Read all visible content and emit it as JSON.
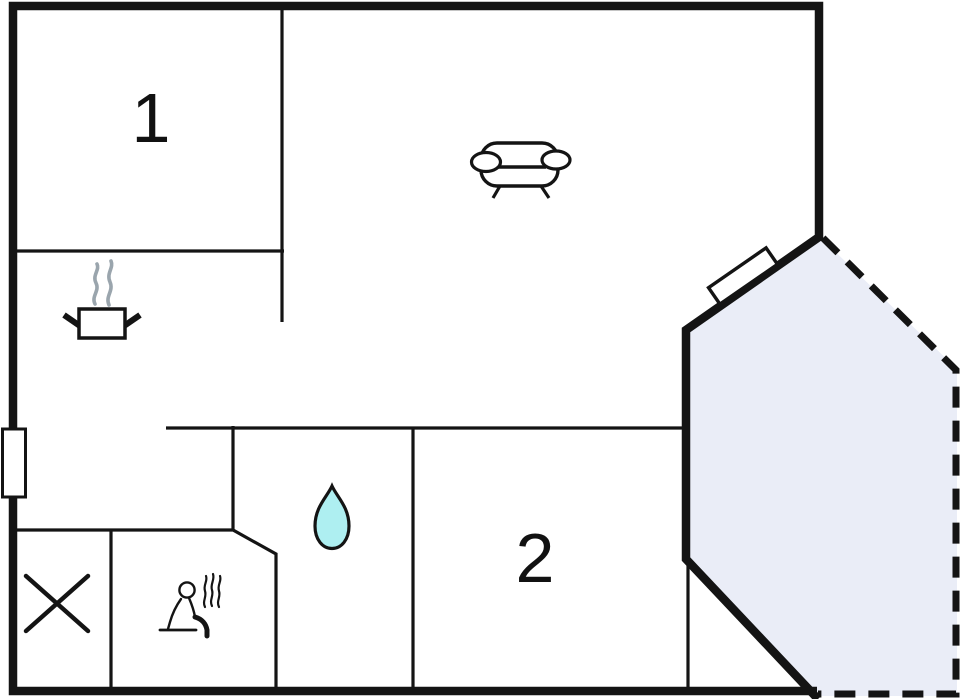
{
  "plan": {
    "rooms": [
      {
        "id": "room-1",
        "label": "1"
      },
      {
        "id": "room-2",
        "label": "2"
      }
    ],
    "icons": [
      {
        "name": "sofa-icon"
      },
      {
        "name": "cooking-pot-icon"
      },
      {
        "name": "steam-icon"
      },
      {
        "name": "water-drop-icon"
      },
      {
        "name": "cross-icon"
      },
      {
        "name": "sauna-person-icon"
      }
    ],
    "features": [
      {
        "name": "left-wall-window"
      },
      {
        "name": "bay-wall-window"
      },
      {
        "name": "terrace"
      }
    ],
    "colors": {
      "wall": "#141414",
      "terrace_fill": "#EAEDF7",
      "drop_fill": "#AEEFF1",
      "steam": "#9AA5AD",
      "label": "#111111"
    }
  }
}
